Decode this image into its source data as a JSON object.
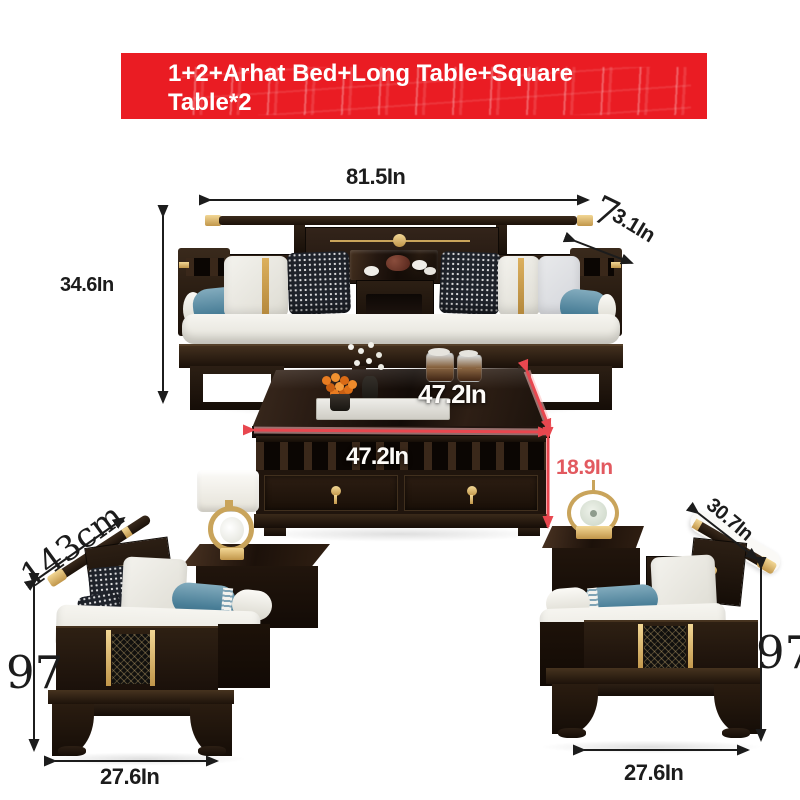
{
  "banner": {
    "line1": "1+2+Arhat Bed+Long Table+Square",
    "line2": "Table*2",
    "background": "#ea1c23",
    "color": "#ffffff"
  },
  "annotations": {
    "sofa_width": "81.5In",
    "rail_glyph": "7",
    "rail_depth": "3.1In",
    "sofa_height": "34.6In",
    "table_top_depth": "47.2In",
    "table_front_width": "47.2In",
    "table_height": "18.9In",
    "left_chair_rail_length": "143cm",
    "left_chair_height": "97",
    "left_chair_width": "27.6In",
    "right_chair_rail_length": "30.7In",
    "right_chair_height": "97",
    "right_chair_width": "27.6In"
  },
  "colors": {
    "annotation_black": "#1c1c1c",
    "annotation_red": "#e2595f",
    "arrow_red": "#e8474f",
    "wood_dark": "#241812",
    "gold": "#c9a45b",
    "cushion_white": "#edece6",
    "bolster_teal": "#5b8ca2",
    "banner_red": "#ea1c23",
    "background": "#ffffff"
  }
}
